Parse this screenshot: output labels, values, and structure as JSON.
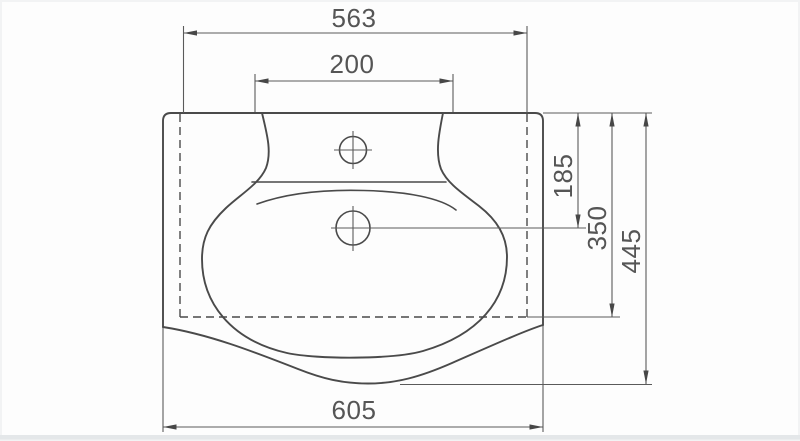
{
  "dimensions": {
    "top_width": "563",
    "faucet_platform_width": "200",
    "bottom_width": "605",
    "drain_center_depth": "185",
    "mount_depth": "350",
    "overall_depth": "445"
  },
  "colors": {
    "line": "#4a4a4a",
    "dim_line": "#5a5a5a",
    "text": "#555555",
    "background": "#fdfdfd",
    "bottom_strip": "#e4e7e9"
  }
}
